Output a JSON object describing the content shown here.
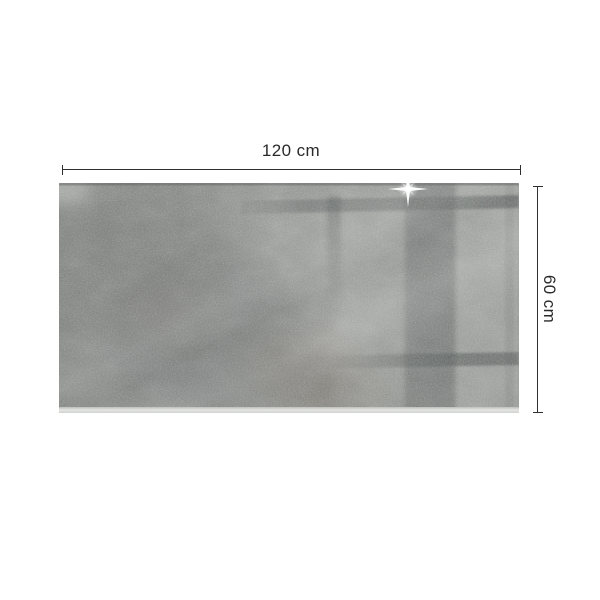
{
  "image": {
    "background_color": "#ffffff"
  },
  "dimensions": {
    "width_label": "120 cm",
    "height_label": "60 cm",
    "line_color": "#2f2f2f",
    "label_color": "#2a2a2a"
  },
  "product": {
    "colors": {
      "base_gray": "#8d908c",
      "dark_shadow": "#595f5e",
      "light_band": "#b5b8b4",
      "reflection_dark_band": "#5a605f",
      "reflection_bar": "#474d4c",
      "rust_tint": "#7c6857",
      "glass_edge": "#e9eae8",
      "sparkle": "#ffffff"
    }
  }
}
